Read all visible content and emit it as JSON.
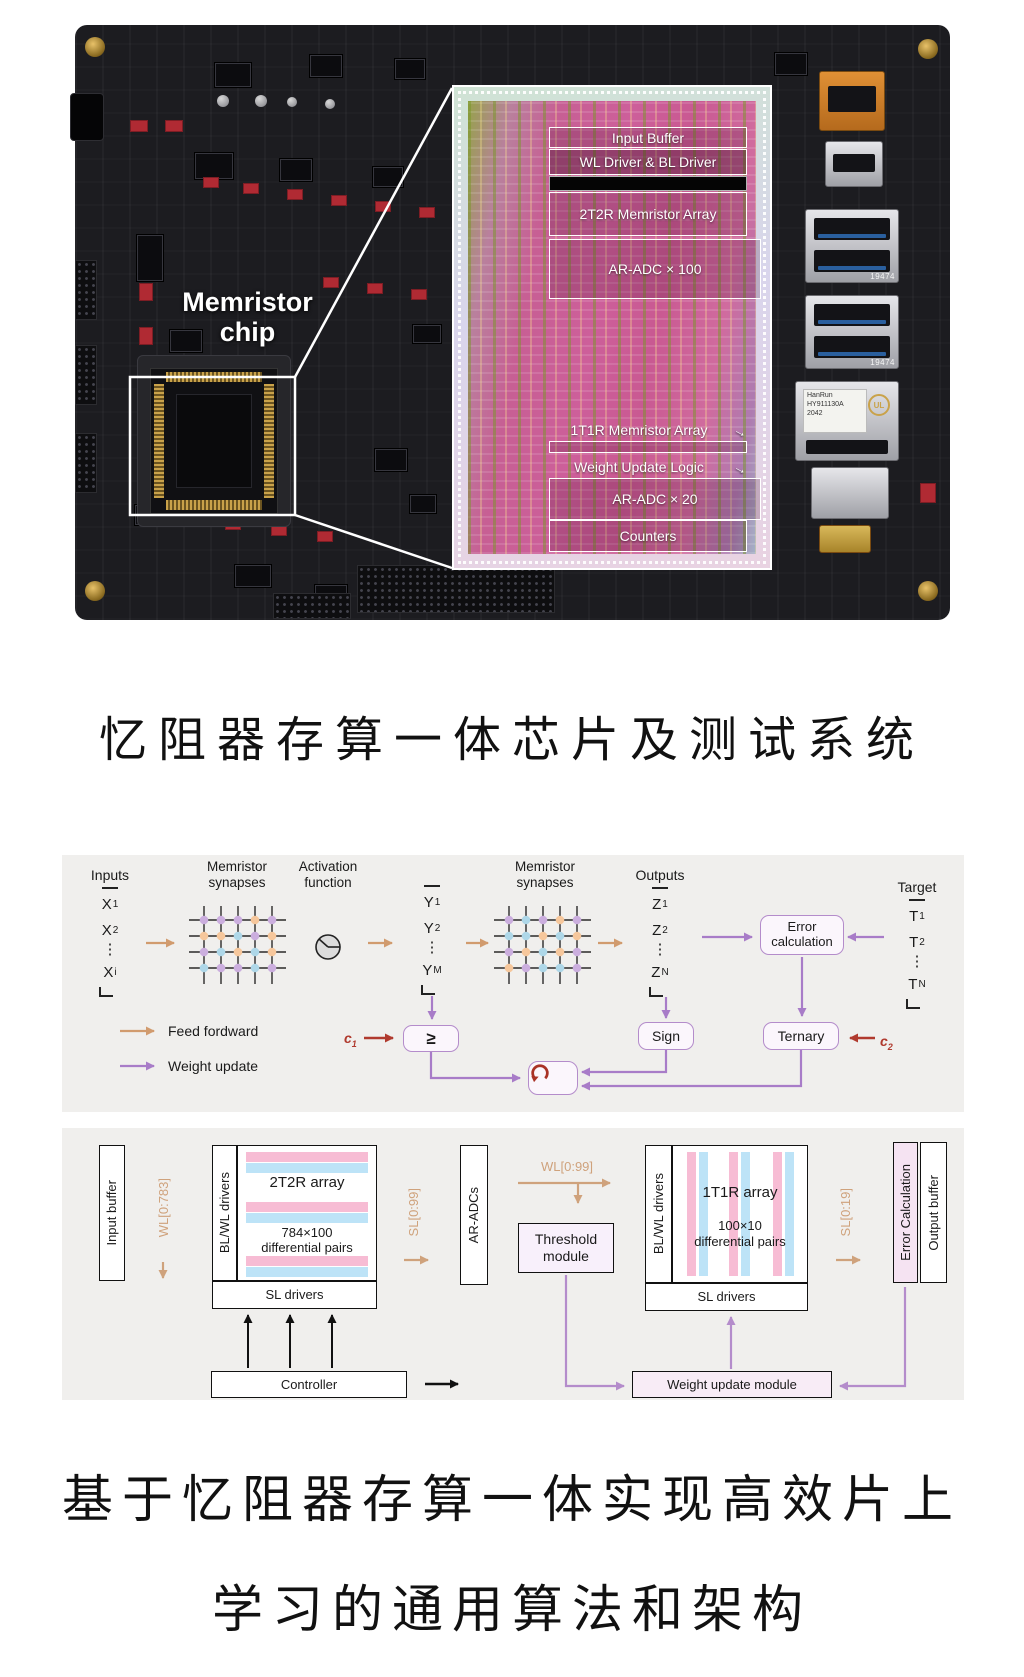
{
  "colors": {
    "panel_bg": "#f0efed",
    "feed_forward_arrow": "#d19b6e",
    "weight_update_arrow": "#a87cc8",
    "constant_arrow": "#b03a2e",
    "stripe_pink": "#f7bcd4",
    "stripe_blue": "#bde3f7",
    "loop_icon_red": "#a93226",
    "synapse_dot_purple": "#cbaede",
    "synapse_dot_peach": "#f6c79c",
    "synapse_dot_blue": "#aed7e8"
  },
  "photo": {
    "board_label_line1": "Memristor",
    "board_label_line2": "chip",
    "die_labels": {
      "input_buffer": "Input Buffer",
      "wl_bl_driver": "WL Driver & BL Driver",
      "array_2t2r": "2T2R Memristor Array",
      "ar_adc_100": "AR-ADC × 100",
      "array_1t1r": "1T1R Memristor Array",
      "weight_update_logic": "Weight Update Logic",
      "ar_adc_20": "AR-ADC × 20",
      "counters": "Counters"
    },
    "port_labels": {
      "usb_top": "19474",
      "usb_bottom": "19474",
      "ethernet_brand": "HanRun",
      "ethernet_part": "HY911130A",
      "ethernet_date": "2042",
      "ethernet_mark": "UL"
    }
  },
  "section_title": "忆阻器存算一体芯片及测试系统",
  "nn": {
    "inputs_label": "Inputs",
    "outputs_label": "Outputs",
    "target_label": "Target",
    "synapses_label_1": "Memristor synapses",
    "synapses_label_2": "Memristor synapses",
    "activation_label": "Activation function",
    "dots": "⋮",
    "x": [
      {
        "base": "X",
        "sub": "1"
      },
      {
        "base": "X",
        "sub": "2"
      },
      {
        "base": "X",
        "sub": "i"
      }
    ],
    "y": [
      {
        "base": "Y",
        "sub": "1"
      },
      {
        "base": "Y",
        "sub": "2"
      },
      {
        "base": "Y",
        "sub": "M"
      }
    ],
    "z": [
      {
        "base": "Z",
        "sub": "1"
      },
      {
        "base": "Z",
        "sub": "2"
      },
      {
        "base": "Z",
        "sub": "N"
      }
    ],
    "t": [
      {
        "base": "T",
        "sub": "1"
      },
      {
        "base": "T",
        "sub": "2"
      },
      {
        "base": "T",
        "sub": "N"
      }
    ],
    "error_calc_label": "Error calculation",
    "sign_label": "Sign",
    "ternary_label": "Ternary",
    "threshold_symbol": "≥",
    "c1_base": "c",
    "c1_sub": "1",
    "c2_base": "c",
    "c2_sub": "2",
    "legend": {
      "feed_forward": "Feed fordward",
      "weight_update": "Weight update"
    }
  },
  "arch": {
    "input_buffer": "Input buffer",
    "wl_0_783": "WL[0:783]",
    "bl_wl_drivers_left": "BL/WL drivers",
    "array_2t2r_title": "2T2R array",
    "array_2t2r_sub1": "784×100",
    "array_2t2r_sub2": "differential pairs",
    "sl_drivers_left": "SL drivers",
    "sl_0_99": "SL[0:99]",
    "ar_adcs": "AR-ADCs",
    "wl_0_99": "WL[0:99]",
    "threshold_module": "Threshold module",
    "bl_wl_drivers_right": "BL/WL drivers",
    "array_1t1r_title": "1T1R array",
    "array_1t1r_sub1": "100×10",
    "array_1t1r_sub2": "differential pairs",
    "sl_drivers_right": "SL drivers",
    "sl_0_19": "SL[0:19]",
    "error_calculation": "Error Calculation",
    "output_buffer": "Output buffer",
    "controller": "Controller",
    "weight_update_module": "Weight update module"
  },
  "caption_line1": "基于忆阻器存算一体实现高效片上",
  "caption_line2": "学习的通用算法和架构"
}
